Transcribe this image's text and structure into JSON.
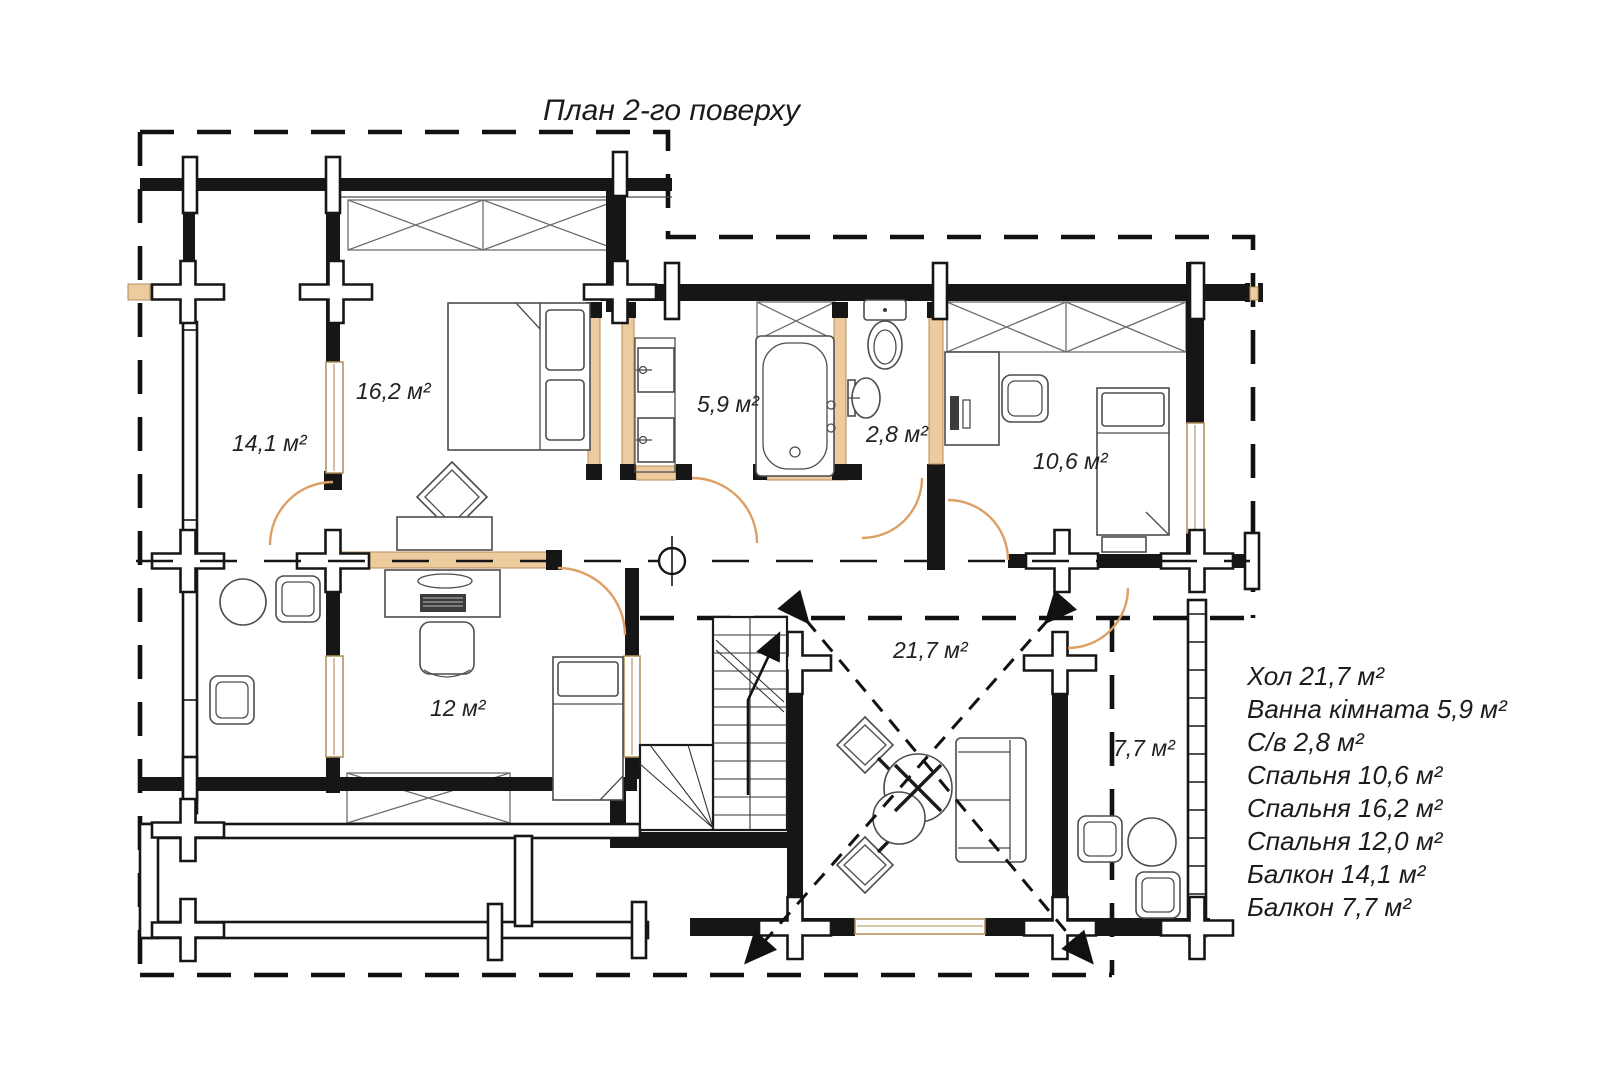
{
  "title": "План 2-го поверху",
  "rooms": {
    "balcony_left": "14,1 м²",
    "bedroom_162": "16,2 м²",
    "bathroom": "5,9 м²",
    "wc": "2,8 м²",
    "bedroom_106": "10,6 м²",
    "bedroom_12": "12 м²",
    "hall": "21,7 м²",
    "balcony_right": "7,7 м²"
  },
  "legend": {
    "items": [
      "Хол 21,7 м²",
      "Ванна кімната 5,9 м²",
      "С/в 2,8 м²",
      "Спальня 10,6 м²",
      "Спальня 16,2 м²",
      "Спальня 12,0 м²",
      "Балкон 14,1 м²",
      "Балкон 7,7 м²"
    ]
  },
  "colors": {
    "wall": "#161616",
    "wood_fill": "#eecb9e",
    "wood_outline": "#b08d55",
    "door_arc": "#dd9f63"
  }
}
